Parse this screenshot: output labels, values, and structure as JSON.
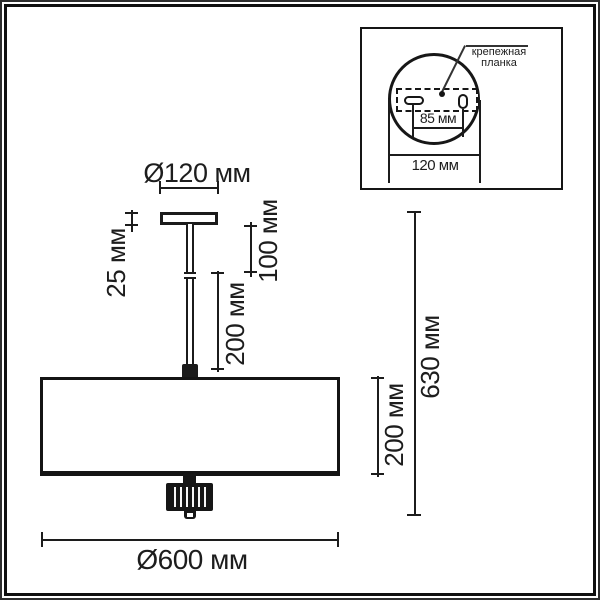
{
  "drawing": {
    "dimensions": {
      "canopy_diameter": "Ø120 мм",
      "canopy_height": "25 мм",
      "rod_upper_length": "100 мм",
      "rod_lower_length": "200 мм",
      "shade_height": "200 мм",
      "total_height": "630 мм",
      "shade_diameter": "Ø600 мм"
    },
    "inset": {
      "bracket_label_line1": "крепежная",
      "bracket_label_line2": "планка",
      "slot_spacing": "85 мм",
      "plate_diameter": "120 мм"
    },
    "colors": {
      "line": "#1c1c1c",
      "background": "#ffffff"
    }
  }
}
